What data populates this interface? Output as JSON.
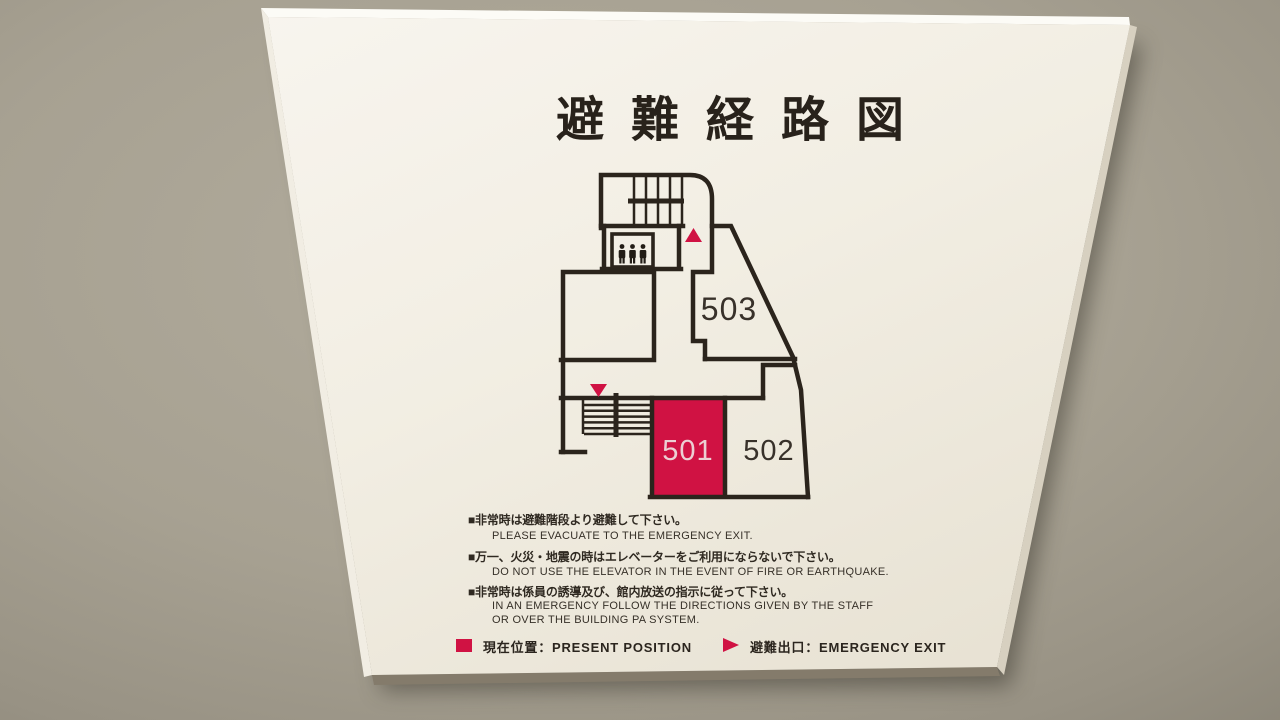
{
  "colors": {
    "accent_red": "#d01243",
    "line_black": "#2b241c",
    "board_white": "#f2eee4",
    "wall_gray": "#a49e8f"
  },
  "sign": {
    "title": "避難経路図",
    "floor_plan": {
      "rooms": [
        {
          "number": "503",
          "highlighted": false
        },
        {
          "number": "501",
          "highlighted": true
        },
        {
          "number": "502",
          "highlighted": false
        }
      ],
      "markers": [
        {
          "name": "emergency-exit-marker-upper",
          "shape": "red-triangle-up"
        },
        {
          "name": "emergency-exit-marker-lower",
          "shape": "red-triangle-down"
        },
        {
          "name": "present-position",
          "shape": "red-filled-room",
          "room": "501"
        }
      ],
      "features": [
        "stairs-upper",
        "stairs-lower",
        "elevator"
      ]
    },
    "notices": [
      {
        "jp": "■非常時は避難階段より避難して下さい。",
        "en": [
          "PLEASE EVACUATE TO THE EMERGENCY EXIT."
        ]
      },
      {
        "jp": "■万一、火災・地震の時はエレベーターをご利用にならないで下さい。",
        "en": [
          "DO NOT USE THE ELEVATOR IN THE EVENT OF FIRE OR EARTHQUAKE."
        ]
      },
      {
        "jp": "■非常時は係員の誘導及び、館内放送の指示に従って下さい。",
        "en": [
          "IN AN EMERGENCY FOLLOW THE DIRECTIONS GIVEN BY THE STAFF",
          "OR OVER THE BUILDING PA SYSTEM."
        ]
      }
    ],
    "legend": {
      "items": [
        {
          "icon": "present-position-swatch",
          "label": "現在位置：PRESENT POSITION"
        },
        {
          "icon": "emergency-exit-arrow",
          "label": "避難出口：EMERGENCY EXIT"
        }
      ]
    }
  }
}
